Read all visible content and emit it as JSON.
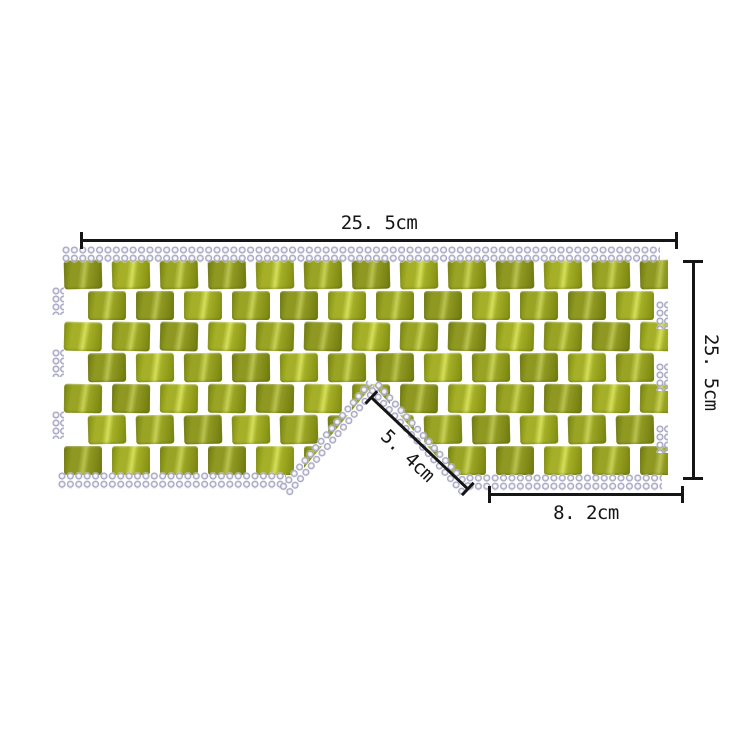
{
  "page": {
    "background": "#ffffff"
  },
  "product": {
    "label": "jade-bead-eye-mask",
    "tile_color": "#9aa424",
    "tile_light": "#c7d055",
    "tile_dark": "#77830f",
    "bead_fill": "#dfdfec",
    "bead_ring": "#9090b0",
    "grid": {
      "rows": 7,
      "cols": 13
    }
  },
  "annotations": {
    "ink_color": "#151515",
    "line_color": "#151515",
    "top_width": "25. 5cm",
    "right_height": "25. 5cm",
    "nose_slant": "5. 4cm",
    "bottom_width": "8. 2cm"
  }
}
